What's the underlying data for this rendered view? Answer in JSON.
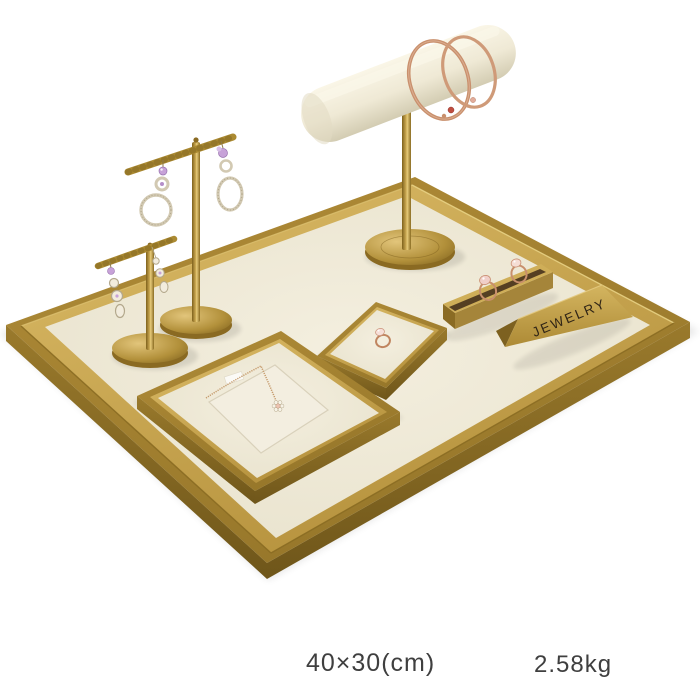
{
  "caption": {
    "size": "40×30(cm)",
    "weight": "2.58kg"
  },
  "sign": {
    "text": "JEWELRY"
  },
  "palette": {
    "background": "#ffffff",
    "brass": "#a98836",
    "brass_light": "#cfae58",
    "brass_dark": "#8a6b26",
    "cream_velvet": "#f0ead8",
    "rose_gold": "#c9906d",
    "crystal": "#efe9d8",
    "amethyst": "#c7a2d8",
    "gem_red": "#c04e40",
    "gem_pink": "#f0cfc8",
    "caption_text": "#3f3f3f",
    "engraved_text": "#2f2416"
  }
}
